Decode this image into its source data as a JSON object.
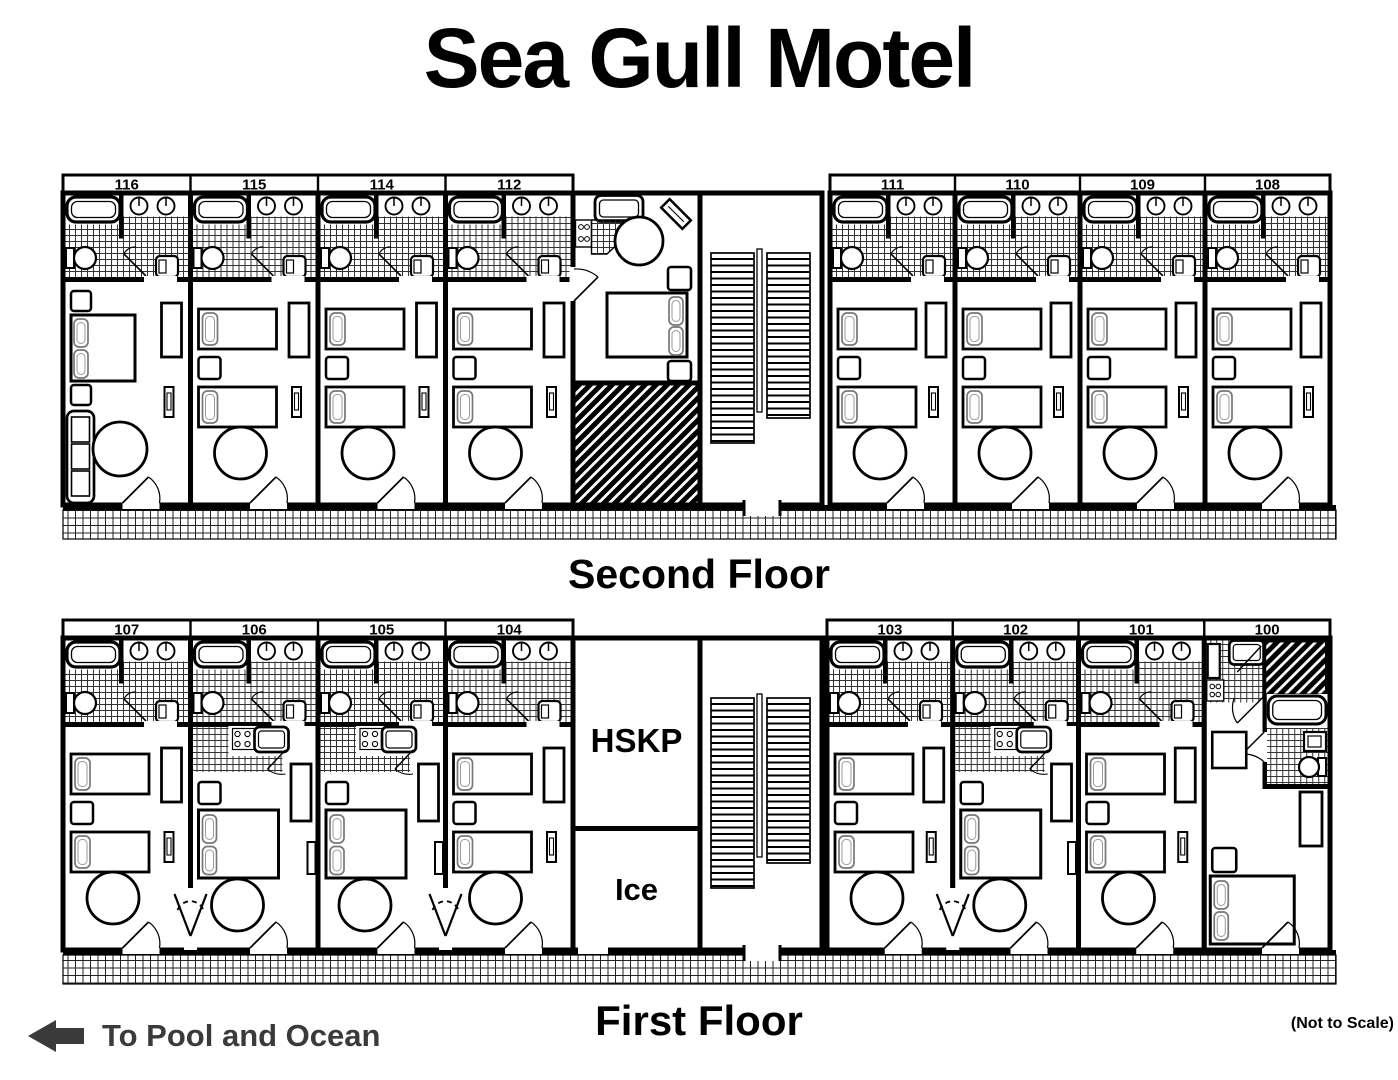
{
  "title": "Sea Gull Motel",
  "floors": [
    {
      "id": "second-floor",
      "label": "Second Floor",
      "left_rooms": [
        {
          "number": "116",
          "type": "king-sofa"
        },
        {
          "number": "115",
          "type": "standard-double"
        },
        {
          "number": "114",
          "type": "standard-double"
        },
        {
          "number": "112",
          "type": "standard-double"
        }
      ],
      "right_rooms": [
        {
          "number": "111",
          "type": "standard-double"
        },
        {
          "number": "110",
          "type": "standard-double"
        },
        {
          "number": "109",
          "type": "standard-double"
        },
        {
          "number": "108",
          "type": "standard-double"
        }
      ]
    },
    {
      "id": "first-floor",
      "label": "First Floor",
      "left_rooms": [
        {
          "number": "107",
          "type": "standard-double"
        },
        {
          "number": "106",
          "type": "king-kitchenette"
        },
        {
          "number": "105",
          "type": "king-kitchenette"
        },
        {
          "number": "104",
          "type": "standard-double"
        }
      ],
      "right_rooms": [
        {
          "number": "103",
          "type": "standard-double"
        },
        {
          "number": "102",
          "type": "king-kitchenette"
        },
        {
          "number": "101",
          "type": "standard-double"
        },
        {
          "number": "100",
          "type": "corner-king-kitchenette"
        }
      ],
      "service_rooms": [
        {
          "label": "HSKP"
        },
        {
          "label": "Ice"
        }
      ]
    }
  ],
  "footer": {
    "pool_label": "To Pool and Ocean",
    "scale_note": "(Not to Scale)"
  },
  "colors": {
    "ink": "#000000",
    "footer_ink": "#3a3a3a",
    "background": "#ffffff"
  }
}
